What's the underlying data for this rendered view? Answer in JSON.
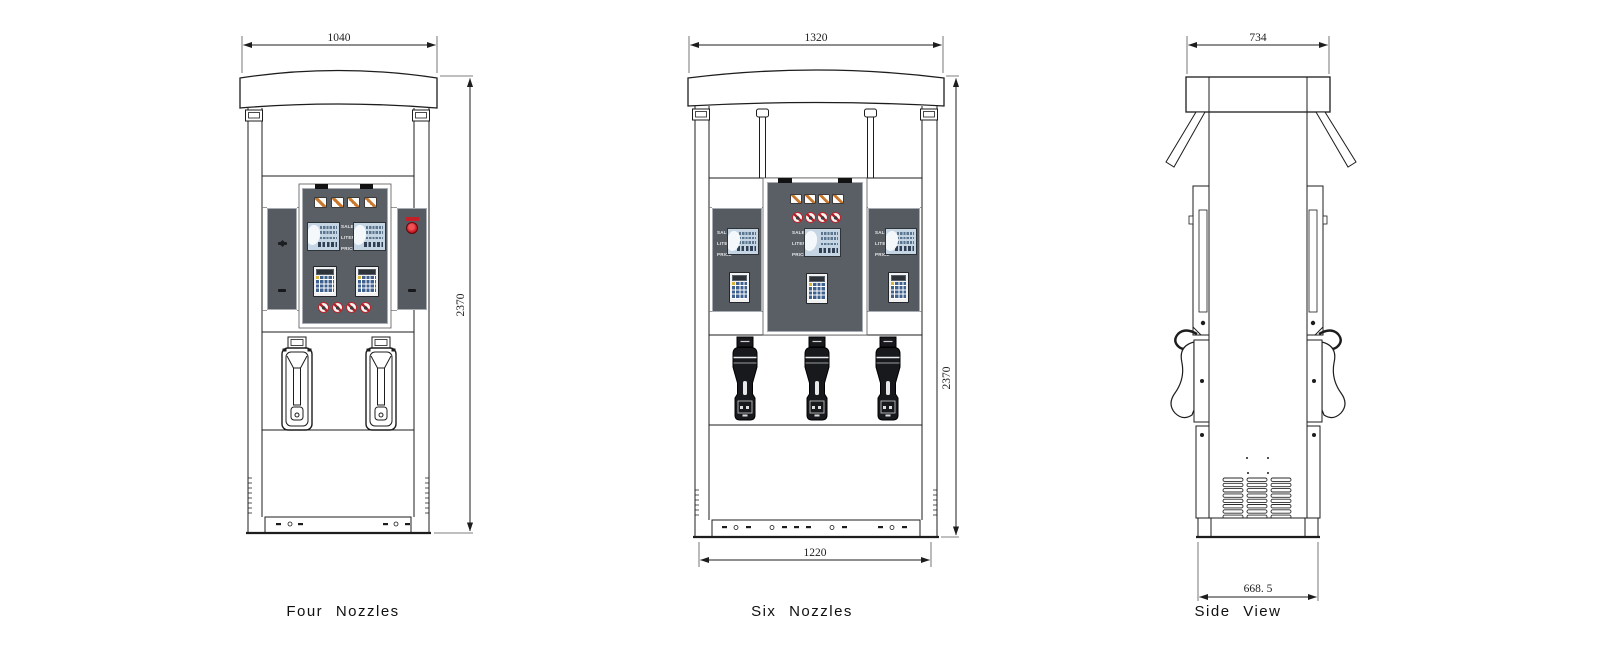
{
  "views": {
    "four": {
      "label": "Four Nozzles",
      "width_dim": "1040",
      "height_dim": "2370"
    },
    "six": {
      "label": "Six Nozzles",
      "width_dim": "1320",
      "height_dim": "2370",
      "base_dim": "1220"
    },
    "side": {
      "label": "Side View",
      "width_dim": "734",
      "base_dim": "668. 5"
    }
  },
  "display_rows": [
    "SALE",
    "LITER",
    "PRICE"
  ],
  "colors": {
    "line": "#1d1d1d",
    "panel_gray": "#565b62",
    "center_panel_gray": "#5a5f66",
    "lcd_blue": "#c6d5e3",
    "red_accent": "#c51f27",
    "keypad_blue": "#3f618f",
    "icon_orange": "#c8782d"
  },
  "icons": {
    "header_icons": [
      "card-icon",
      "card-icon",
      "card-icon",
      "card-icon"
    ],
    "prohibition_icons": [
      "no-smoking-icon",
      "no-open-flame-icon",
      "no-phone-icon",
      "engine-off-icon"
    ]
  }
}
